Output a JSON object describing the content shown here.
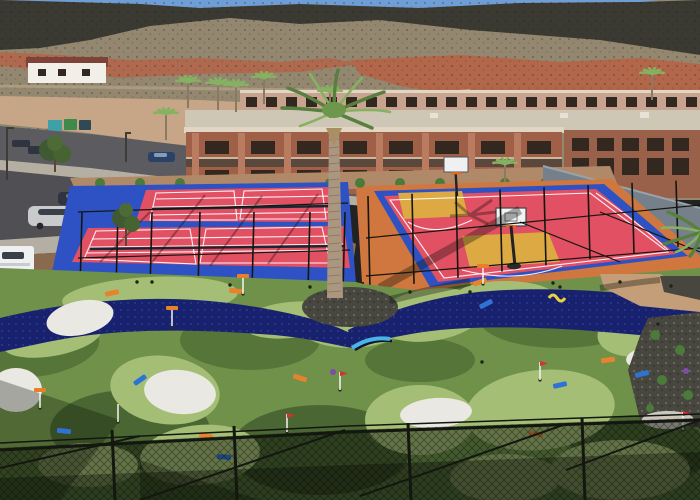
{
  "scene": {
    "description_elements": [
      "desert-hillside",
      "white-house",
      "dirt-lot",
      "dumpsters",
      "street",
      "parked-vehicles",
      "hotel-buildings",
      "pickleball-courts",
      "basketball-court",
      "central-palm-tree",
      "mini-golf-course",
      "river-water-feature",
      "sand-bunkers",
      "foreground-chain-link-fence"
    ]
  },
  "palette": {
    "sky": "#6f9ed6",
    "scree": "#93876f",
    "rockDark": "#3a3a33",
    "dirtRed": "#b2664a",
    "dirtLot": "#c7a687",
    "dirtLot2": "#8a6a4f",
    "dirtBehind": "#b08a68",
    "dirtPath": "#c3b096",
    "asphalt": "#5c5c60",
    "asphalt2": "#505054",
    "sidewalk": "#b5afa3",
    "houseWall": "#f1efe8",
    "houseRoof": "#7e4338",
    "roofLight": "#cfc7b6",
    "backWing": "#c8a390",
    "coping": "#e0d6c3",
    "hotelBrick": "#a06048",
    "hotelPilaster": "#b97c60",
    "windowDark": "#33281f",
    "brickRight": "#99604a",
    "windscreen": "#76808a",
    "courtBlue": "#2e52c4",
    "courtRed": "#e25064",
    "keyYellow": "#dca943",
    "apronOrange": "#d0763f",
    "golfBase": "#6f914a",
    "golfDark": "#567539",
    "golfDark2": "#4a6733",
    "golfLight": "#a5be76",
    "river": "#18216e",
    "riverSpark": "#32429e",
    "sand": "#e9e8e3",
    "rockBed": "#474740",
    "pathTan": "#c49e79",
    "shrub": "#4c7a39",
    "palmTrunk": "#ab9780",
    "palmFrond": "#597f3e",
    "palmFrond2": "#86b161",
    "fence": "#14170f",
    "bridgeBlue": "#49b4e8",
    "rampOrange": "#e6832f",
    "rampBlue": "#2f72d6",
    "rampYellow": "#ecd23f",
    "rampPurple": "#7b4fa8",
    "flagOrange": "#e8802a",
    "flagRed": "#d0342c",
    "carSilver": "#c8cacc",
    "carBlue": "#2b4268",
    "carDark": "#2e3440",
    "truckWhite": "#eef0f2",
    "dumpsterTeal": "#3fa0a8",
    "dumpsterGreen": "#3d8a4a",
    "dumpsterSlate": "#2f4a55"
  },
  "flags": [
    {
      "x": 172,
      "y": 326,
      "c": "orange"
    },
    {
      "x": 243,
      "y": 294,
      "c": "orange"
    },
    {
      "x": 40,
      "y": 408,
      "c": "orange"
    },
    {
      "x": 483,
      "y": 284,
      "c": "orange"
    },
    {
      "x": 340,
      "y": 390,
      "c": "red"
    },
    {
      "x": 287,
      "y": 432,
      "c": "red"
    },
    {
      "x": 683,
      "y": 430,
      "c": "red"
    },
    {
      "x": 540,
      "y": 380,
      "c": "red"
    },
    {
      "x": 118,
      "y": 422,
      "c": "white"
    }
  ],
  "obstacles": [
    {
      "x": 112,
      "y": 293,
      "r": -12,
      "c": "orange"
    },
    {
      "x": 236,
      "y": 291,
      "r": 8,
      "c": "orange"
    },
    {
      "x": 300,
      "y": 378,
      "r": 18,
      "c": "orange"
    },
    {
      "x": 206,
      "y": 436,
      "r": 10,
      "c": "orange"
    },
    {
      "x": 536,
      "y": 434,
      "r": 6,
      "c": "orange"
    },
    {
      "x": 608,
      "y": 360,
      "r": -8,
      "c": "orange"
    },
    {
      "x": 480,
      "y": 282,
      "r": -18,
      "c": "orange"
    },
    {
      "x": 140,
      "y": 380,
      "r": -35,
      "c": "blue"
    },
    {
      "x": 64,
      "y": 431,
      "r": 6,
      "c": "blue"
    },
    {
      "x": 224,
      "y": 457,
      "r": 4,
      "c": "blue"
    },
    {
      "x": 560,
      "y": 385,
      "r": -12,
      "c": "blue"
    },
    {
      "x": 642,
      "y": 374,
      "r": -14,
      "c": "blue"
    },
    {
      "x": 486,
      "y": 304,
      "r": -28,
      "c": "blue"
    },
    {
      "x": 556,
      "y": 298,
      "r": 0,
      "c": "yellow"
    },
    {
      "x": 333,
      "y": 372,
      "r": 0,
      "c": "purple"
    },
    {
      "x": 686,
      "y": 371,
      "r": 0,
      "c": "purple"
    }
  ],
  "tee_dots": [
    {
      "x": 137,
      "y": 282
    },
    {
      "x": 152,
      "y": 282
    },
    {
      "x": 230,
      "y": 285
    },
    {
      "x": 310,
      "y": 287
    },
    {
      "x": 410,
      "y": 292
    },
    {
      "x": 470,
      "y": 292
    },
    {
      "x": 560,
      "y": 287
    },
    {
      "x": 620,
      "y": 282
    },
    {
      "x": 553,
      "y": 283
    },
    {
      "x": 671,
      "y": 286
    },
    {
      "x": 658,
      "y": 324
    },
    {
      "x": 482,
      "y": 362
    }
  ],
  "bg_palms": [
    {
      "x": 188,
      "y": 108
    },
    {
      "x": 218,
      "y": 110
    },
    {
      "x": 236,
      "y": 112
    },
    {
      "x": 264,
      "y": 104
    },
    {
      "x": 166,
      "y": 140
    },
    {
      "x": 652,
      "y": 100
    },
    {
      "x": 505,
      "y": 190
    },
    {
      "x": 330,
      "y": 118
    }
  ],
  "shrub_row": [
    100,
    140,
    180,
    330,
    360,
    400,
    440,
    505,
    545
  ],
  "vehicles": [
    "white-pickup-truck",
    "silver-suv",
    "dark-suv",
    "blue-sedan",
    "two-dark-parked-cars"
  ],
  "dumpsters": [
    "teal",
    "green",
    "slate"
  ]
}
